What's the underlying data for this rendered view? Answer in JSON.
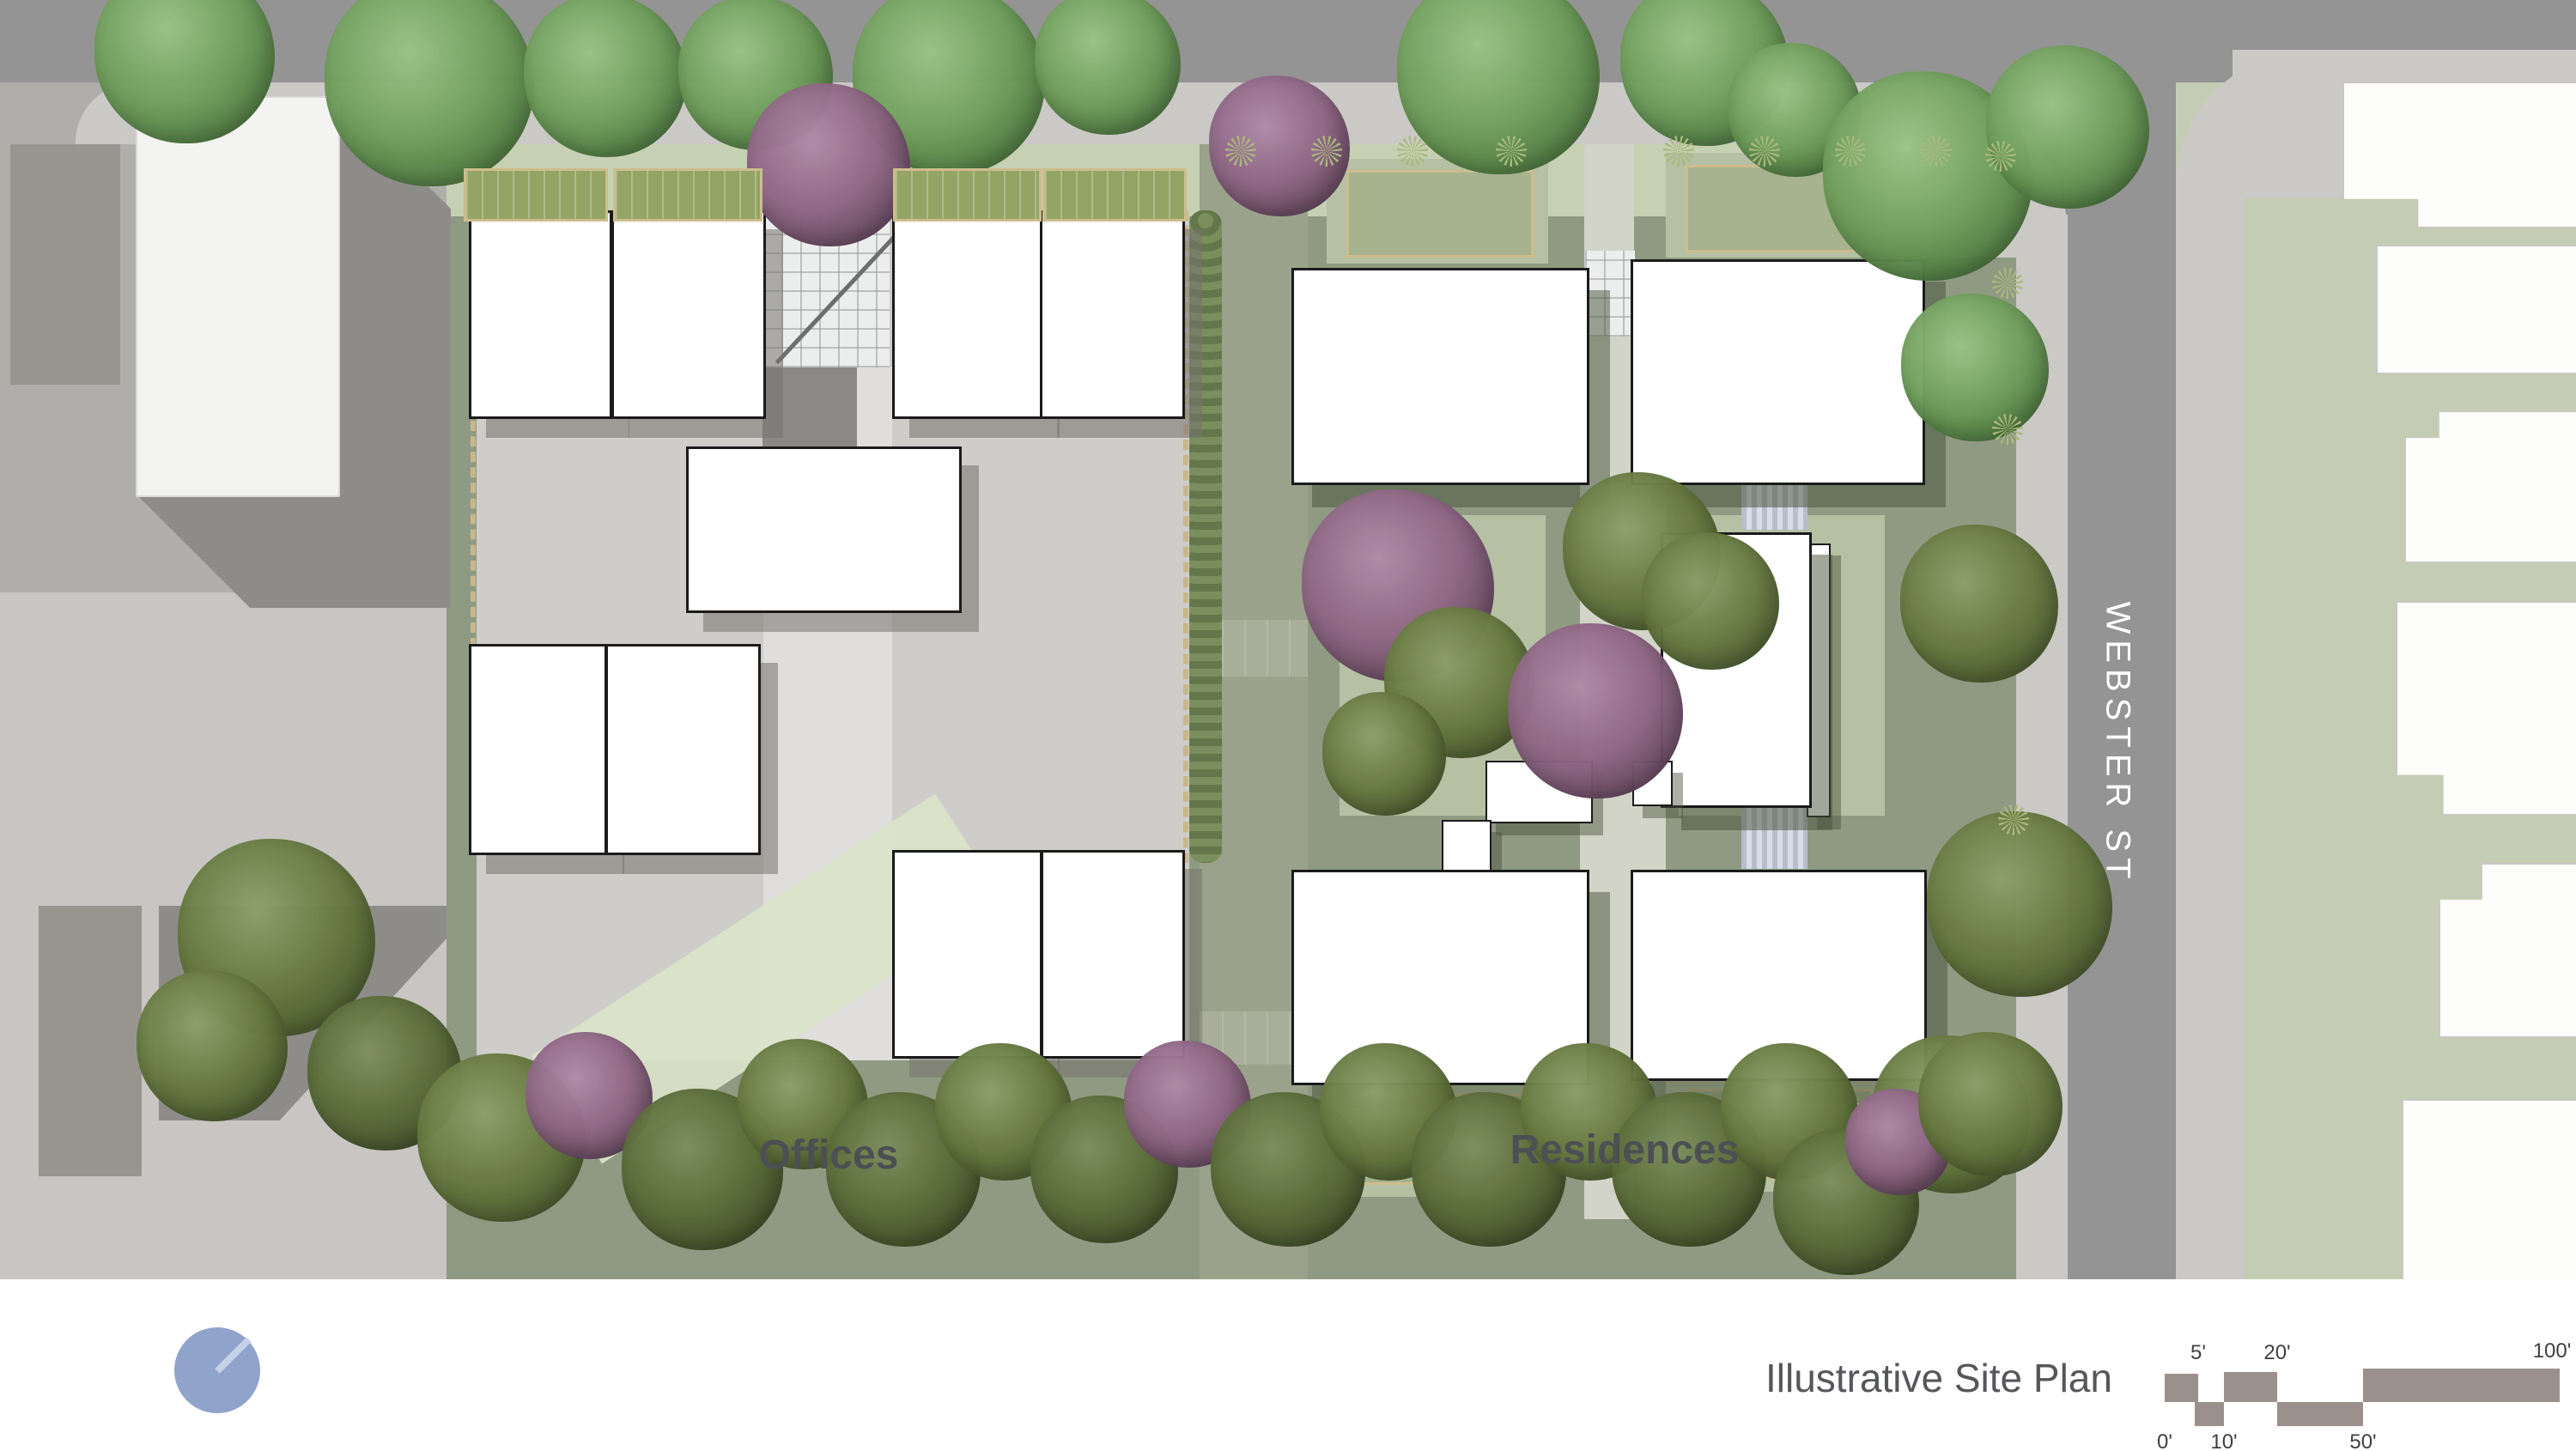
{
  "title": {
    "text": "Illustrative Site Plan"
  },
  "labels": {
    "offices": "Offices",
    "residences": "Residences"
  },
  "street": {
    "name": "WEBSTER ST"
  },
  "scale_bar": {
    "top_ticks": [
      "5'",
      "20'",
      "100'"
    ],
    "bottom_ticks": [
      "0'",
      "10'",
      "50'"
    ]
  },
  "colors": {
    "compass_blue": "#8fa3cb",
    "building_white": "#ffffff",
    "site_green": "#8f9a82",
    "courtyard_sage": "#b6c0a3",
    "road_gray": "#949494",
    "sidewalk_gray": "#cbc9c6",
    "scalebar_taupe": "#9b908b",
    "tree_green": "#6f9e5b",
    "tree_olive": "#66793f",
    "tree_purple": "#8d6583"
  }
}
